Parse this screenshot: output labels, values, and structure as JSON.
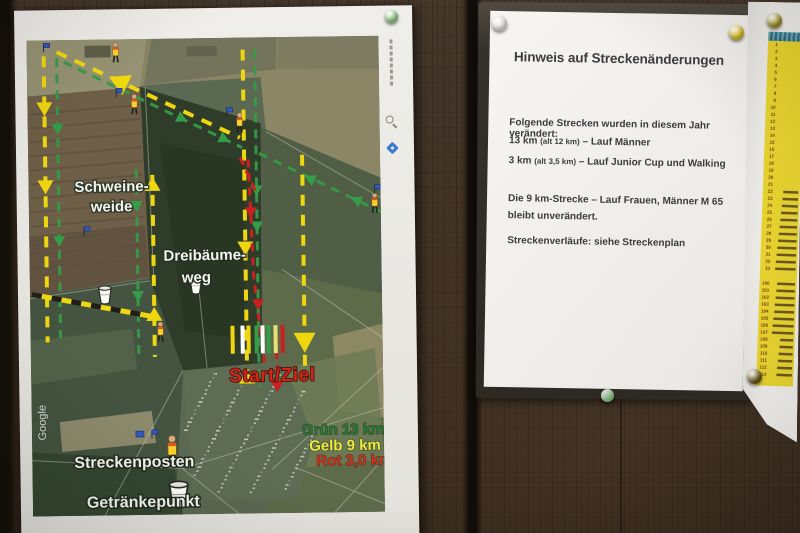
{
  "map_poster": {
    "labels": {
      "pig_pasture_line1": "Schweine-",
      "pig_pasture_line2": "weide",
      "three_trees_line1": "Dreibäume-",
      "three_trees_line2": "weg",
      "start_finish": "Start/Ziel",
      "marshal_legend": "Streckenposten",
      "drink_legend": "Getränkepunkt",
      "watermark": "Google"
    },
    "route_legend": [
      {
        "text": "Grün 13 km",
        "color": "#1d7c32"
      },
      {
        "text": "Gelb  9 km",
        "color": "#f0ee2e"
      },
      {
        "text": "Rot 3,0 km",
        "color": "#e22b16"
      }
    ],
    "route_colors": {
      "green": "#2f9e42",
      "yellow": "#f2d800",
      "red": "#d81c1c"
    }
  },
  "notice": {
    "title": "Hinweis auf Streckenänderungen",
    "intro": "Folgende Strecken wurden in diesem Jahr verändert:",
    "changes": [
      {
        "distance": "13 km",
        "old": "(alt 12 km)",
        "desc": "– Lauf Männer"
      },
      {
        "distance": "3 km",
        "old": "(alt 3,5 km)",
        "desc": "– Lauf Junior Cup und Walking"
      }
    ],
    "unchanged_line1": "Die  9 km-Strecke – Lauf Frauen, Männer M 65",
    "unchanged_line2": "bleibt unverändert.",
    "footer": "Streckenverläufe:  siehe Streckenplan"
  },
  "start_list": {
    "block1_numbers": [
      1,
      2,
      3,
      4,
      5,
      6,
      7,
      8,
      9,
      10,
      11,
      12,
      13,
      14,
      15,
      16,
      17,
      18,
      19,
      20,
      21,
      22,
      23,
      24,
      25,
      26,
      27,
      28,
      29,
      30,
      31,
      32,
      33
    ],
    "block2_numbers": [
      100,
      101,
      102,
      103,
      104,
      105,
      106,
      107,
      108,
      109,
      110,
      111,
      112,
      113
    ],
    "names_visible_from_row": 22
  },
  "pins": {
    "map_poster_top": "#8fd08a",
    "notice_top_left": "#e6e6e0",
    "notice_top_right": "#e5ca1c",
    "board_bottom_center": "#8fd08a",
    "list_sheet_top": "#ad9b24",
    "list_sheet_bottom": "#6b5c1a"
  }
}
